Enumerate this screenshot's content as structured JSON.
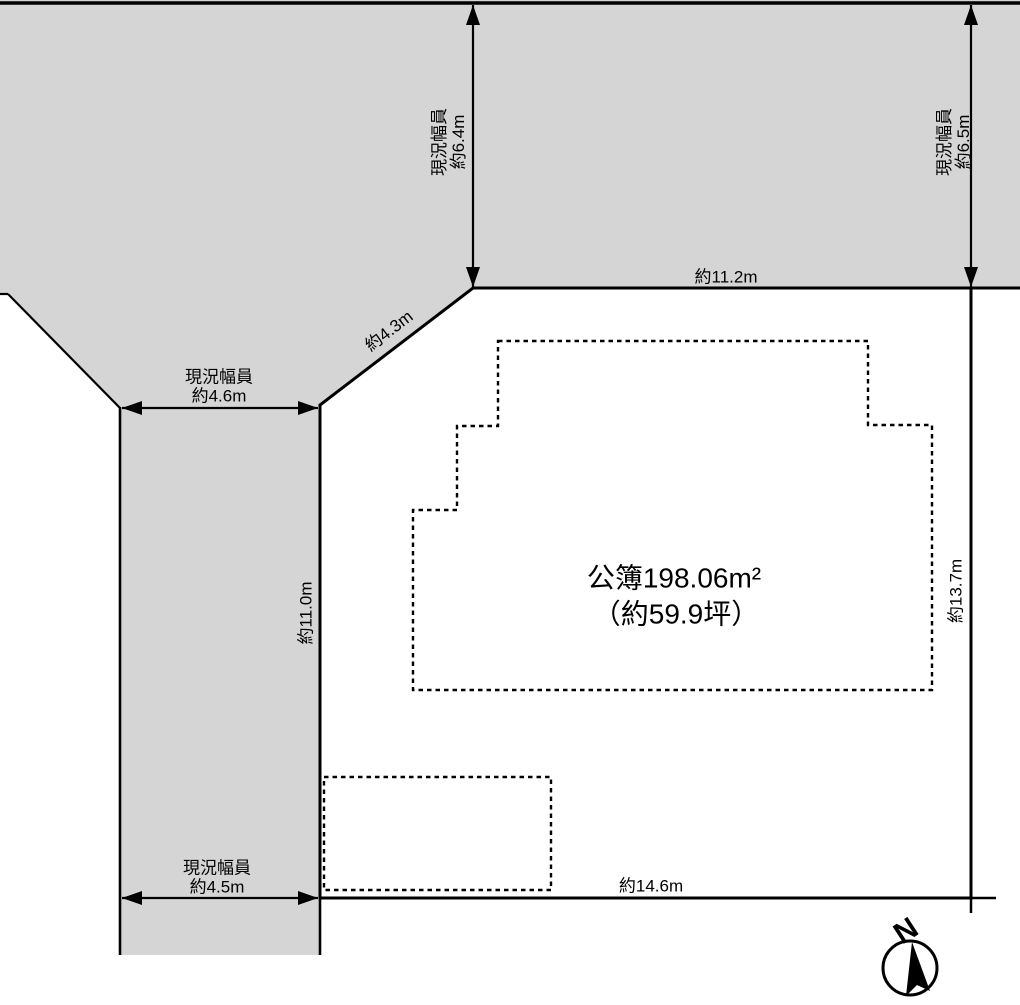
{
  "plot": {
    "area_line1": "公簿198.06m²",
    "area_line2": "（約59.9坪）"
  },
  "edges": {
    "north": "約11.2m",
    "northwest_diagonal": "約4.3m",
    "west": "約11.0m",
    "east": "約13.7m",
    "south": "約14.6m"
  },
  "roads": {
    "top_left": {
      "line1": "現況幅員",
      "line2": "約6.4m"
    },
    "top_right": {
      "line1": "現況幅員",
      "line2": "約6.5m"
    },
    "west_upper": {
      "line1": "現況幅員",
      "line2": "約4.6m"
    },
    "west_lower": {
      "line1": "現況幅員",
      "line2": "約4.5m"
    }
  },
  "compass": {
    "north_label": "N"
  },
  "colors": {
    "background": "#ffffff",
    "road": "#d5d5d5",
    "plot": "#e9efdc",
    "line": "#000000"
  }
}
